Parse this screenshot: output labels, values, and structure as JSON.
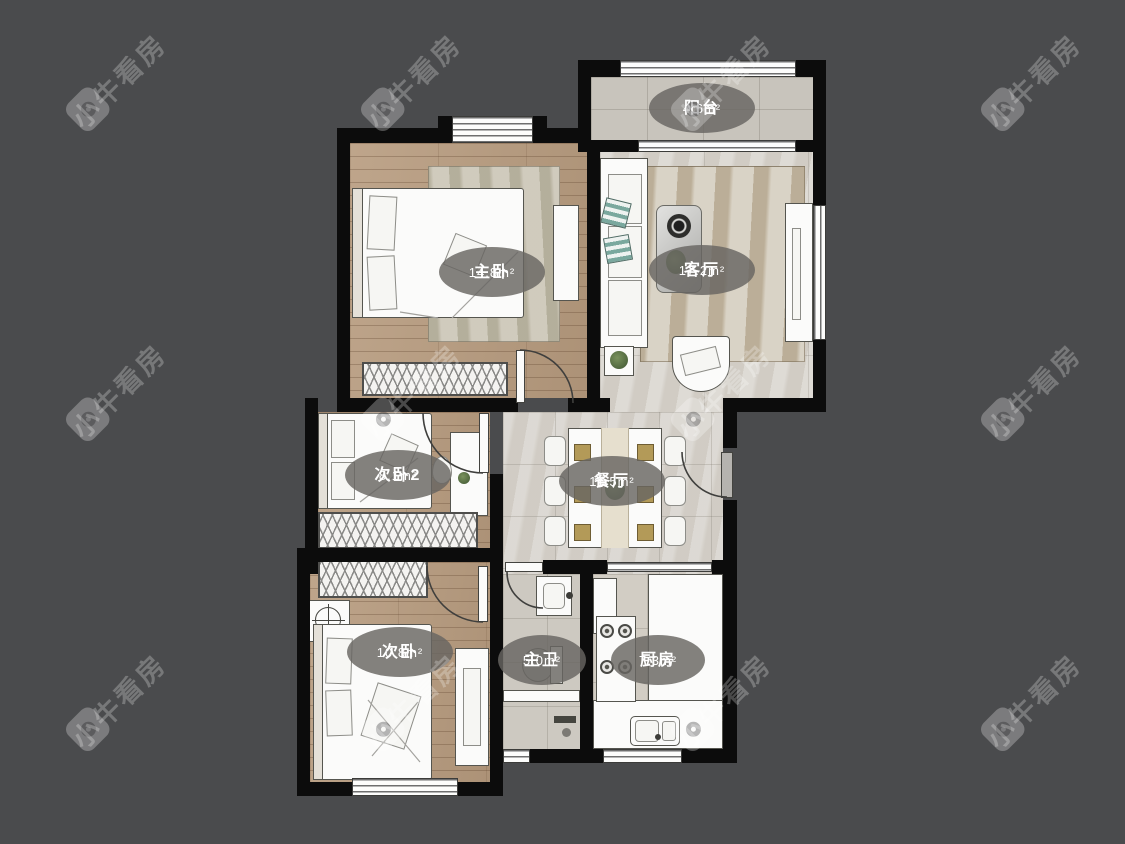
{
  "brand": {
    "watermark_text": "小牛看房"
  },
  "rooms": [
    {
      "name": "阳台",
      "area": "4.6m²"
    },
    {
      "name": "主卧",
      "area": "14.8m²"
    },
    {
      "name": "客厅",
      "area": "17.2m²"
    },
    {
      "name": "次卧2",
      "area": "8.1m²"
    },
    {
      "name": "餐厅",
      "area": "11.5m²"
    },
    {
      "name": "次卧",
      "area": "10.8m²"
    },
    {
      "name": "主卫",
      "area": "5.0m²"
    },
    {
      "name": "厨房",
      "area": "7.3m²"
    }
  ],
  "colors": {
    "background": "#4a4b4d",
    "wall": "#0c0c0c",
    "wood_floor": "#b79b7e",
    "tile_floor": "#d6d2cb",
    "label_bubble": "#686561",
    "cushion_accent": "#7aa89e"
  }
}
